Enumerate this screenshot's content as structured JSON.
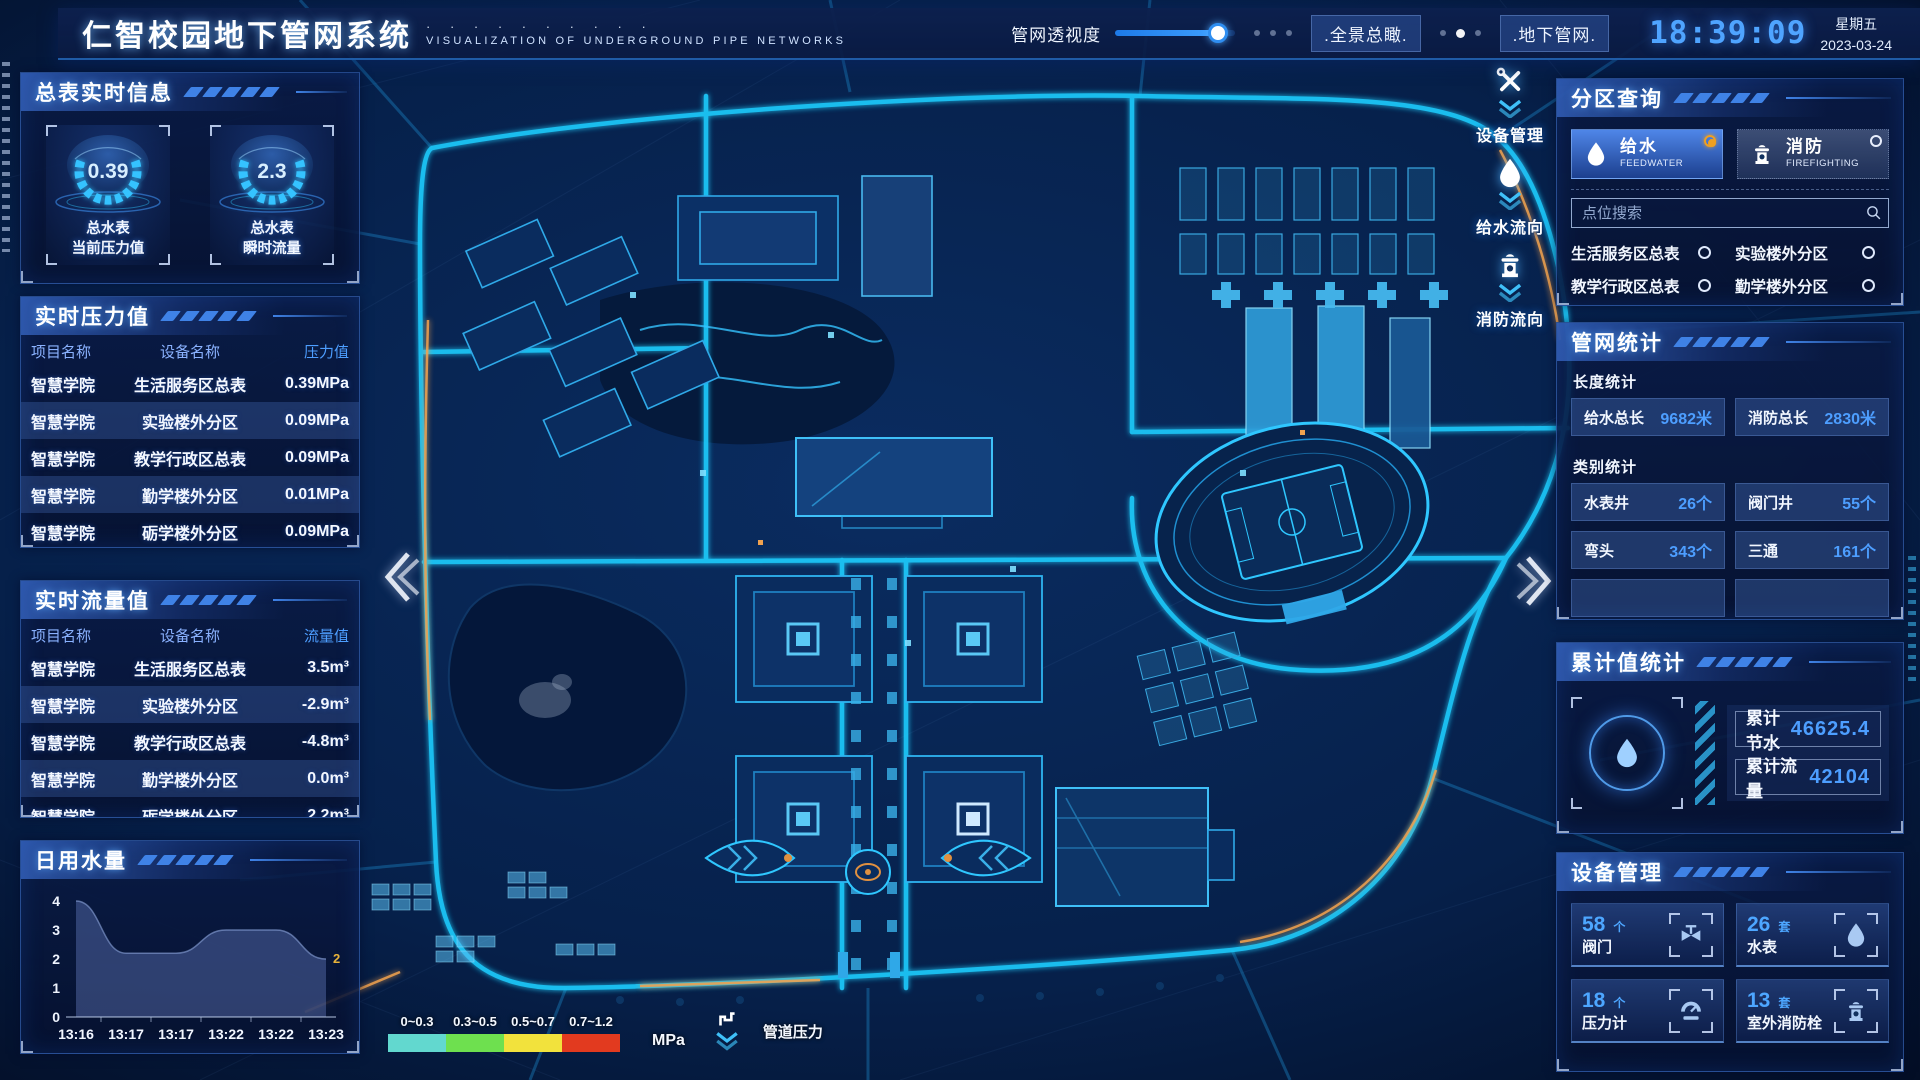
{
  "header": {
    "title": "仁智校园地下管网系统",
    "subtitle": "VISUALIZATION OF UNDERGROUND PIPE NETWORKS",
    "dots": "· · · · · · · · · ·",
    "slider_label": "管网透视度",
    "btn_overview": ".全景总瞰.",
    "btn_underground": ".地下管网.",
    "clock": "18:39:09",
    "weekday": "星期五",
    "date": "2023-03-24"
  },
  "left": {
    "summary": {
      "title": "总表实时信息",
      "gauges": [
        {
          "value": "0.39",
          "label1": "总水表",
          "label2": "当前压力值"
        },
        {
          "value": "2.3",
          "label1": "总水表",
          "label2": "瞬时流量"
        }
      ]
    },
    "pressure": {
      "title": "实时压力值",
      "columns": [
        "项目名称",
        "设备名称",
        "压力值"
      ],
      "rows": [
        [
          "智慧学院",
          "生活服务区总表",
          "0.39MPa"
        ],
        [
          "智慧学院",
          "实验楼外分区",
          "0.09MPa"
        ],
        [
          "智慧学院",
          "教学行政区总表",
          "0.09MPa"
        ],
        [
          "智慧学院",
          "勤学楼外分区",
          "0.01MPa"
        ],
        [
          "智慧学院",
          "砺学楼外分区",
          "0.09MPa"
        ]
      ]
    },
    "flow": {
      "title": "实时流量值",
      "columns": [
        "项目名称",
        "设备名称",
        "流量值"
      ],
      "rows": [
        [
          "智慧学院",
          "生活服务区总表",
          "3.5m³"
        ],
        [
          "智慧学院",
          "实验楼外分区",
          "-2.9m³"
        ],
        [
          "智慧学院",
          "教学行政区总表",
          "-4.8m³"
        ],
        [
          "智慧学院",
          "勤学楼外分区",
          "0.0m³"
        ],
        [
          "智慧学院",
          "砺学楼外分区",
          "2.2m³"
        ]
      ]
    },
    "daily": {
      "title": "日用水量"
    }
  },
  "chart_data": {
    "type": "area",
    "title": "日用水量",
    "x": [
      "13:16",
      "13:17",
      "13:17",
      "13:22",
      "13:22",
      "13:23"
    ],
    "values": [
      4,
      2.2,
      2.2,
      3,
      3,
      2
    ],
    "ylim": [
      0,
      4
    ],
    "yticks": [
      0,
      1,
      2,
      3,
      4
    ],
    "end_label": "2",
    "end_label_color": "#e8b33a",
    "area_color": "#6f87cd"
  },
  "right": {
    "query": {
      "title": "分区查询",
      "tabs": [
        {
          "label": "给水",
          "sub": "FEEDWATER",
          "selected": true
        },
        {
          "label": "消防",
          "sub": "FIREFIGHTING",
          "selected": false
        }
      ],
      "search_placeholder": "点位搜索",
      "options": [
        "生活服务区总表",
        "实验楼外分区",
        "教学行政区总表",
        "勤学楼外分区",
        "砺学楼外分区",
        "宿舍区泵房"
      ]
    },
    "pipe_stats": {
      "title": "管网统计",
      "length_title": "长度统计",
      "length_items": [
        {
          "label": "给水总长",
          "value": "9682米"
        },
        {
          "label": "消防总长",
          "value": "2830米"
        }
      ],
      "category_title": "类别统计",
      "category_items": [
        {
          "label": "水表井",
          "value": "26个"
        },
        {
          "label": "阀门井",
          "value": "55个"
        },
        {
          "label": "弯头",
          "value": "343个"
        },
        {
          "label": "三通",
          "value": "161个"
        }
      ]
    },
    "cumulative": {
      "title": "累计值统计",
      "items": [
        {
          "label": "累计节水",
          "value": "46625.4"
        },
        {
          "label": "累计流量",
          "value": "42104"
        }
      ]
    },
    "devices": {
      "title": "设备管理",
      "cards": [
        {
          "count": "58",
          "unit": "个",
          "label": "阀门",
          "icon": "valve-icon"
        },
        {
          "count": "26",
          "unit": "套",
          "label": "水表",
          "icon": "water-drop-icon"
        },
        {
          "count": "18",
          "unit": "个",
          "label": "压力计",
          "icon": "pressure-gauge-icon"
        },
        {
          "count": "13",
          "unit": "套",
          "label": "室外消防栓",
          "icon": "hydrant-icon"
        }
      ]
    }
  },
  "map": {
    "float_tools": [
      {
        "label": "设备管理",
        "icon": "tools-icon"
      },
      {
        "label": "给水流向",
        "icon": "water-drop-icon"
      },
      {
        "label": "消防流向",
        "icon": "hydrant-icon"
      }
    ],
    "legend": {
      "ranges": [
        {
          "label": "0~0.3",
          "color": "#62d8cf"
        },
        {
          "label": "0.3~0.5",
          "color": "#6ee04f"
        },
        {
          "label": "0.5~0.7",
          "color": "#f2e23c"
        },
        {
          "label": "0.7~1.2",
          "color": "#e23a1f"
        }
      ],
      "unit": "MPa",
      "label": "管道压力"
    }
  }
}
